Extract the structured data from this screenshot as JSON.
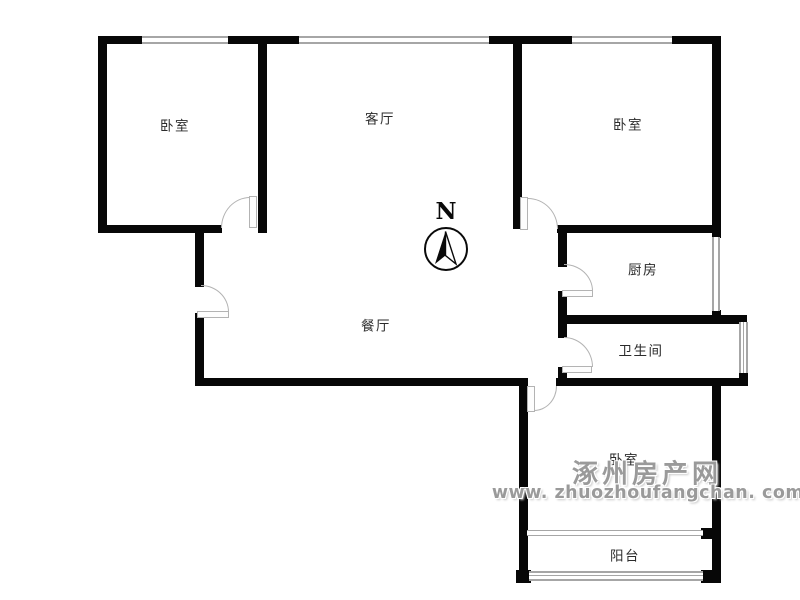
{
  "plan": {
    "rooms": [
      {
        "id": "bedroom-top-left",
        "label": "卧室"
      },
      {
        "id": "living-room",
        "label": "客厅"
      },
      {
        "id": "bedroom-top-right",
        "label": "卧室"
      },
      {
        "id": "kitchen",
        "label": "厨房"
      },
      {
        "id": "dining-room",
        "label": "餐厅"
      },
      {
        "id": "bathroom",
        "label": "卫生间"
      },
      {
        "id": "bedroom-bottom",
        "label": "卧室"
      },
      {
        "id": "balcony",
        "label": "阳台"
      }
    ],
    "compass": {
      "label": "N"
    },
    "watermark": {
      "line1": "涿州房产网",
      "line2": "www. zhuozhoufangchan. com"
    },
    "colors": {
      "wall": "#070707",
      "window_line": "#a6a6a6",
      "door_line": "#b3b3b3",
      "label_text": "#2b2b2b",
      "watermark_gray": "#9a9a9a",
      "background": "#ffffff"
    }
  }
}
